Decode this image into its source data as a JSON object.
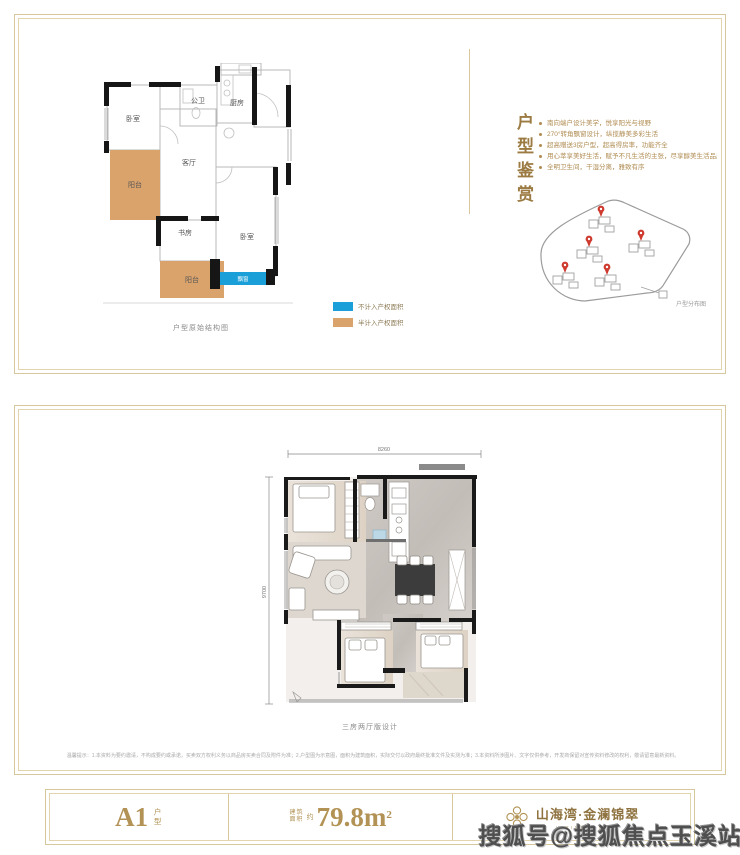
{
  "panel1": {
    "plan": {
      "caption": "户型原始结构图",
      "rooms": {
        "bedroom1": "卧室",
        "bath": "公卫",
        "kitchen": "厨房",
        "balcony1": "阳台",
        "living": "客厅",
        "study": "书房",
        "bedroom2": "卧室",
        "balcony2": "阳台",
        "bay_window": "飘窗"
      }
    },
    "legend": [
      {
        "color": "#1b9fd8",
        "label": "不计入产权面积"
      },
      {
        "color": "#dba36c",
        "label": "半计入产权面积"
      }
    ],
    "appreciation": {
      "title": "户型鉴赏",
      "bullets": [
        "南向端户设计美学，悦享阳光与视野",
        "270°转角飘窗设计，纵揽静美多彩生活",
        "超高赠送3房户型，超高得房率，功能齐全",
        "用心萃享美好生活，赋予不凡生活的主张，尽享醇美生活品质",
        "全明卫生间，干湿分离，雅致有序"
      ]
    },
    "sitemap": {
      "caption": "户型分布图"
    }
  },
  "panel2": {
    "dims": {
      "width": "8260",
      "height": "9700"
    },
    "caption": "三房两厅版设计",
    "disclaimer": "温馨提示：1.本资料为要约邀请，不构成要约或承诺，买卖双方权利义务以商品房买卖合同及附件为准；2.户型图为示意图，面积为建筑面积，实际交付以政府最终批准文件及实测为准；3.本资料所涉图片、文字仅供参考，开发商保留对宣传资料修改的权利，敬请留意最新资料。"
  },
  "footer": {
    "unit": {
      "name": "A1",
      "suffix": "户型"
    },
    "area": {
      "prefix_top": "建筑",
      "prefix_bottom": "面积",
      "approx": "约",
      "value": "79.8m",
      "sup": "2"
    },
    "brand": {
      "name": "山海湾·金澜锦翠",
      "sub": "VIRINITY CITY"
    }
  },
  "watermark": "搜狐号@搜狐焦点玉溪站",
  "colors": {
    "accent_gold": "#a8874f",
    "border_gold": "#d7c79c",
    "legend_blue": "#1b9fd8",
    "legend_tan": "#dba36c",
    "pin_red": "#cf3a2f",
    "wall_black": "#161616",
    "watermark_gray": "#4f4f4f"
  }
}
